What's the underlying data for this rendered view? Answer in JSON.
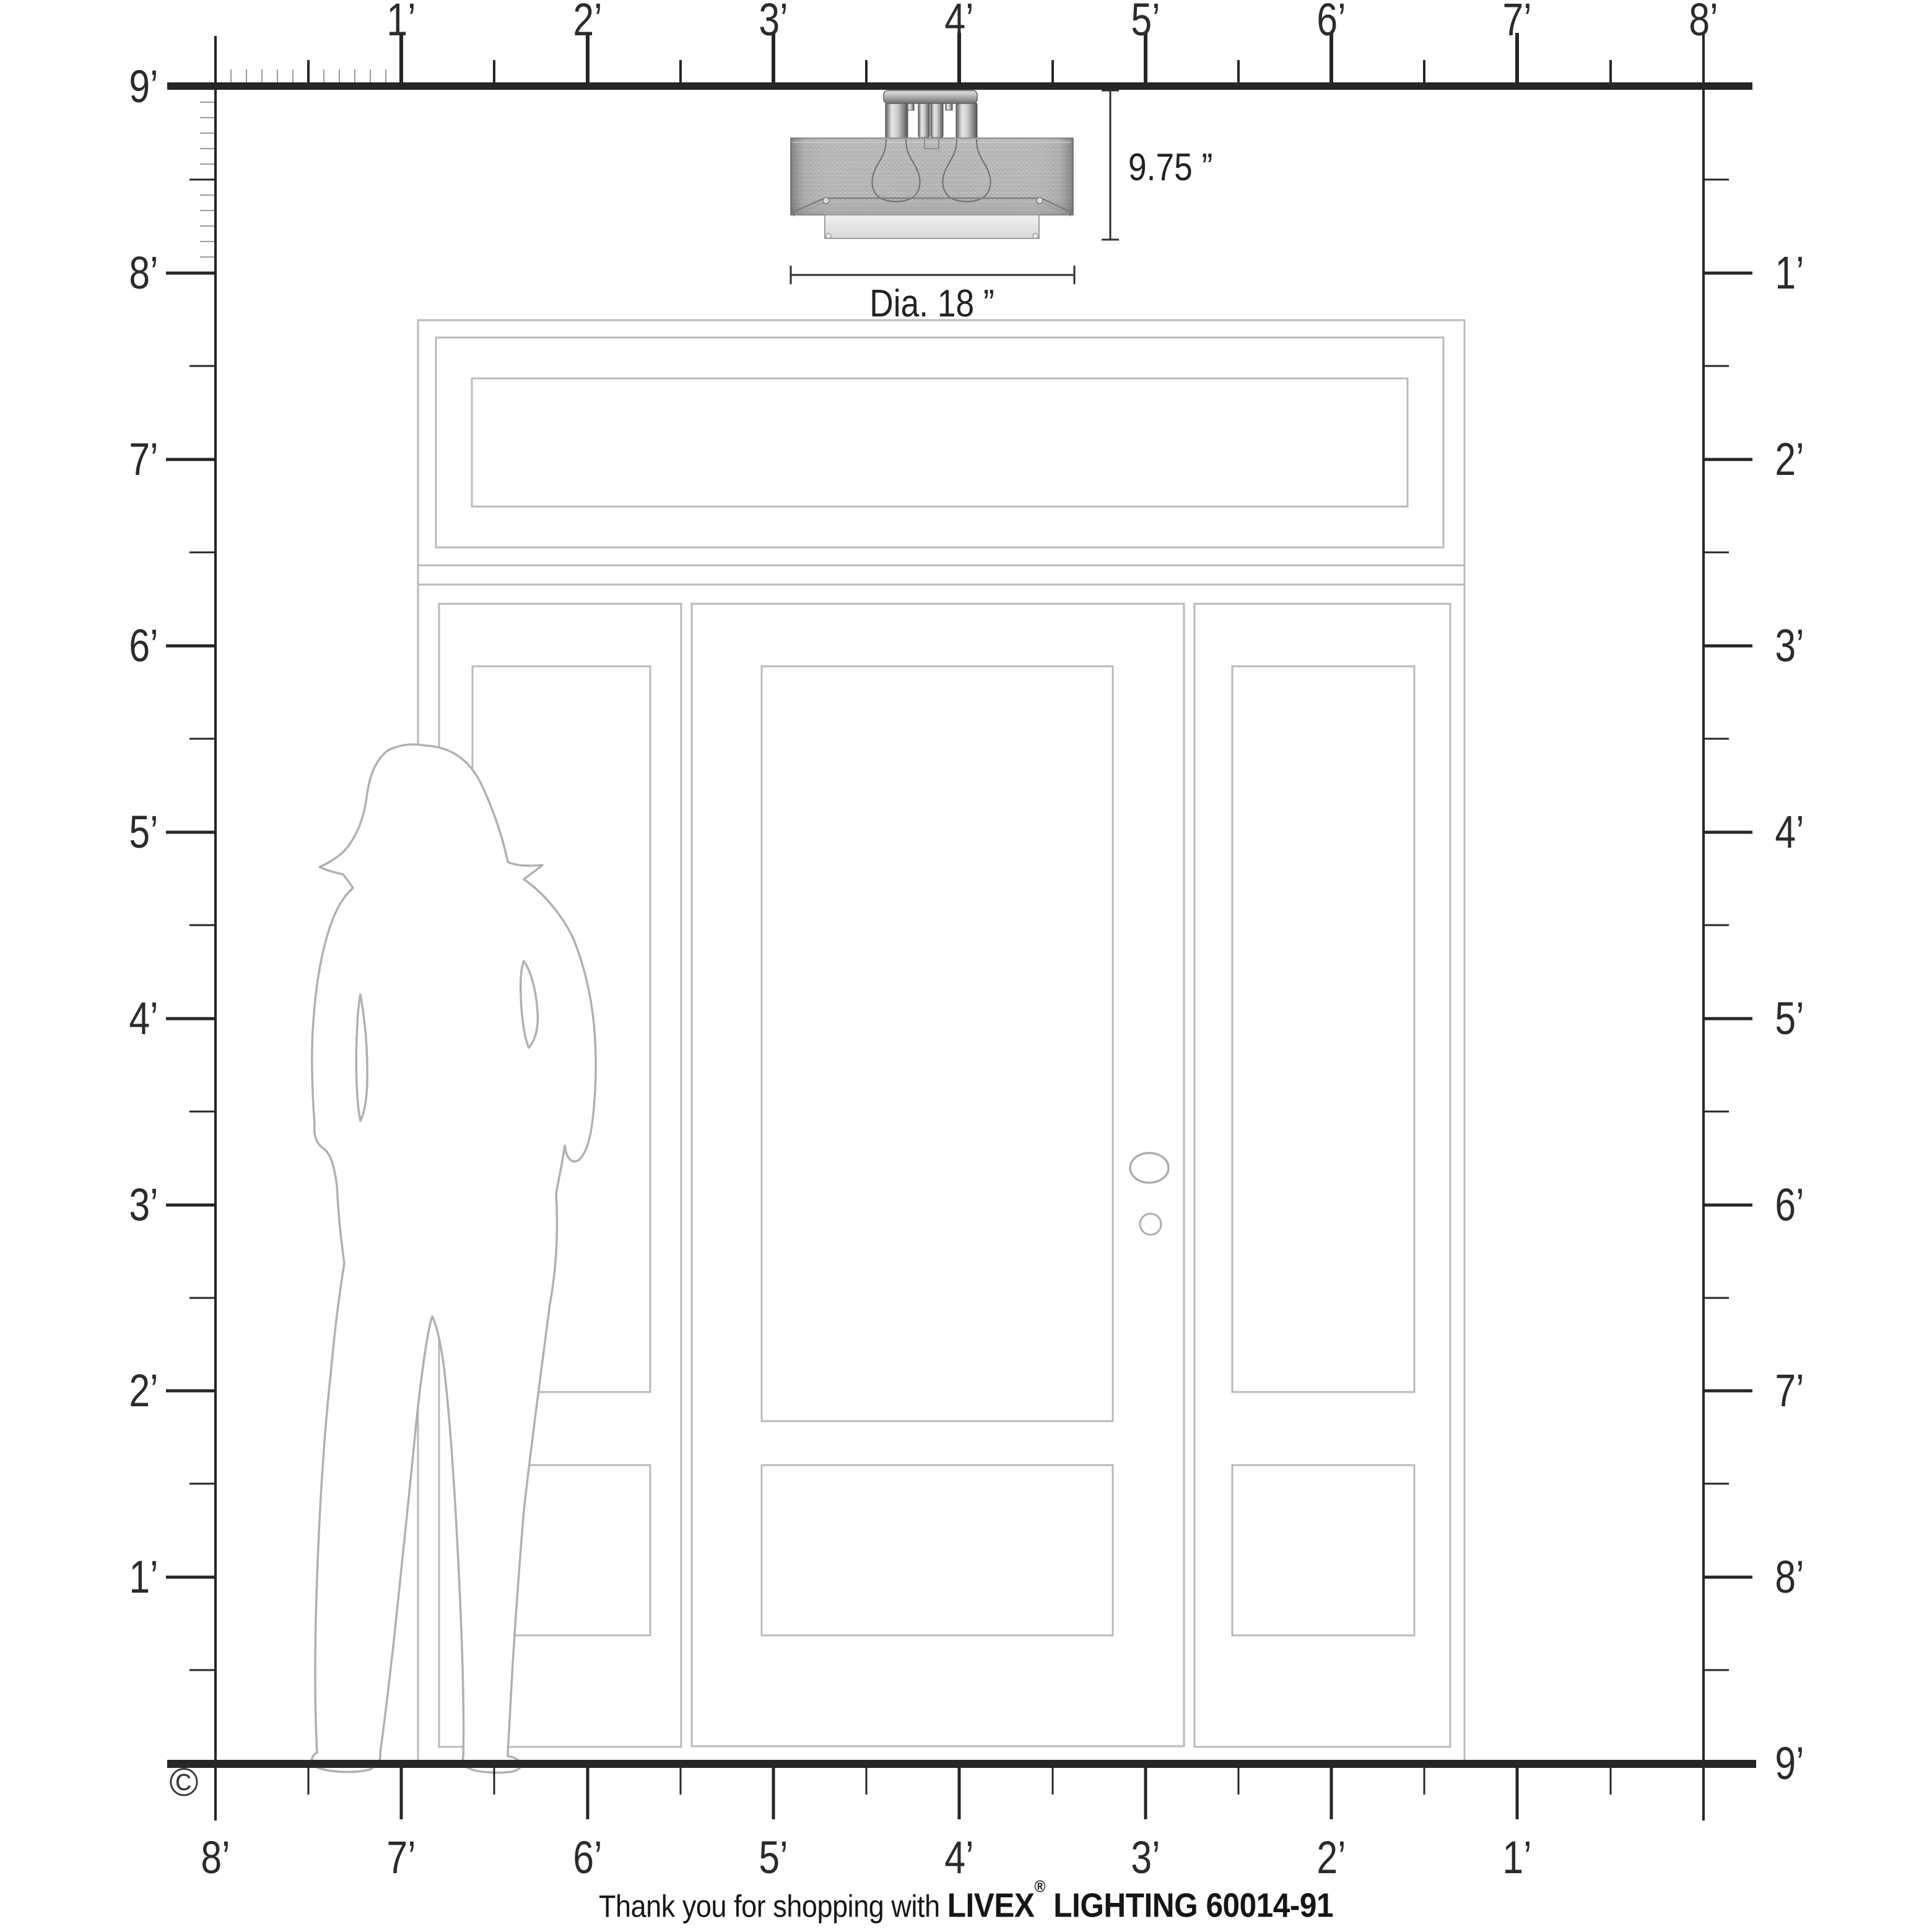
{
  "page": {
    "description": "Scale diagram of a flush-mount ceiling light over an entry door with sidelights, with foot rulers on all four sides and a human figure for scale"
  },
  "rulers": {
    "top": [
      "1’",
      "2’",
      "3’",
      "4’",
      "5’",
      "6’",
      "7’",
      "8’"
    ],
    "left": [
      "9’",
      "8’",
      "7’",
      "6’",
      "5’",
      "4’",
      "3’",
      "2’",
      "1’"
    ],
    "right": [
      "1’",
      "2’",
      "3’",
      "4’",
      "5’",
      "6’",
      "7’",
      "8’",
      "9’"
    ],
    "bottom": [
      "8’",
      "7’",
      "6’",
      "5’",
      "4’",
      "3’",
      "2’",
      "1’"
    ]
  },
  "fixture": {
    "height_label": "9.75 ”",
    "diameter_label": "Dia. 18 ”"
  },
  "footer": {
    "prefix": "Thank you for shopping with ",
    "brand": "LIVEX",
    "registered": "®",
    "suffix": " LIGHTING 60014-91"
  },
  "copyright_symbol": "©",
  "colors": {
    "ruler": "#262626",
    "label_text": "#2b2b2b",
    "door_line": "#b9b9b9",
    "silhouette_line": "#b0b0b0",
    "shade_fabric": "#bcbcbc",
    "diffuser": "#e9e9e9"
  }
}
